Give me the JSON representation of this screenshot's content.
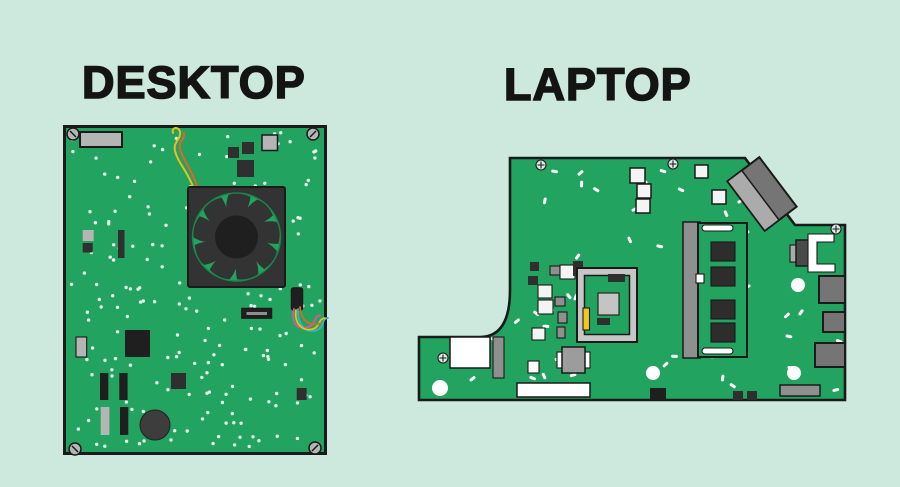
{
  "palette": {
    "background": "#cde8dc",
    "board_green": "#22a35f",
    "outline": "#1a1a1a",
    "component_dark": "#2f2f2f",
    "component_black": "#1f1f1f",
    "light_gray": "#b5b5b5",
    "mid_gray": "#8f8f8f",
    "port_gray": "#757575",
    "socket_gray": "#c6c6c6",
    "white": "#ffffff",
    "white_square": "#f4f4f4",
    "wire_yellow": "#e5c01e",
    "wire_orange": "#e2662a",
    "wire_pink": "#e2539b",
    "wire_blue": "#30b6c9",
    "accent_yellow": "#f2c71d",
    "fan_body": "#333333",
    "fan_hub": "#1f1f1f",
    "fan_ring": "#12884b",
    "capacitor_gray": "#3d3d3d",
    "title_color": "#141414"
  },
  "desktop": {
    "title": "DESKTOP",
    "components": [
      "io-port",
      "corner-screws",
      "jumper-wires",
      "cpu-fan",
      "fan-hub",
      "chips",
      "expansion-slot",
      "power-connector",
      "colored-wires",
      "capacitor",
      "memory-bars",
      "solder-dots"
    ]
  },
  "laptop": {
    "title": "LAPTOP",
    "components": [
      "corner-screws",
      "white-capacitor-squares",
      "wifi-antenna-connector",
      "cpu-socket",
      "cpu-die",
      "yellow-latch",
      "ram-module",
      "ram-chips",
      "heat-bracket",
      "side-ports",
      "mounting-holes",
      "label-sticker",
      "solder-dashes"
    ]
  }
}
